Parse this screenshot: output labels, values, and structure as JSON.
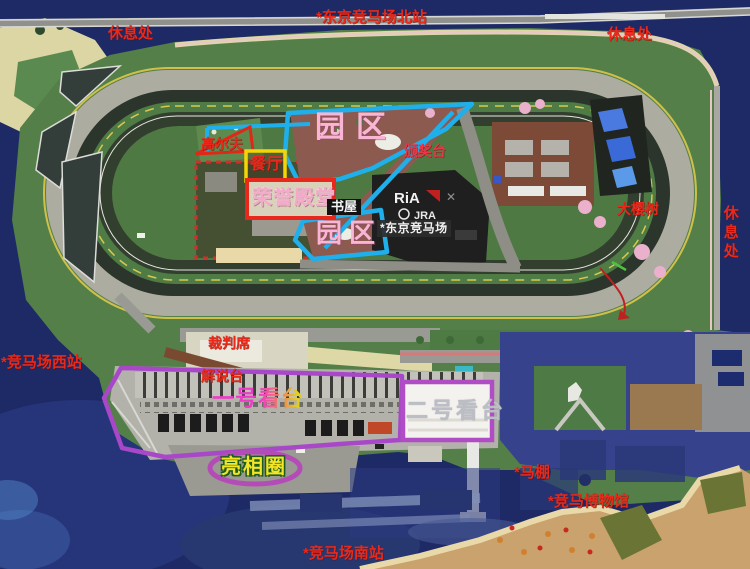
{
  "map": {
    "title": "东京竞马场",
    "colors": {
      "water": "#1d2a66",
      "grass": "#547f49",
      "annotation_red": "#e8291b",
      "annotation_cyan": "#1fb0ec",
      "annotation_purple": "#a848c8",
      "annotation_magenta": "#b44cb8",
      "box_yellow": "#f5d504",
      "box_red": "#e8281c",
      "park_pink": "#f8b6d4",
      "paddock_yellow": "#f2e428",
      "grandstand1_magenta": "#ee3cc8"
    },
    "labels": {
      "rest_area_top_left": "休息处",
      "north_station": "*东京竞马场北站",
      "rest_area_top_right": "休息处",
      "golf": "高尔夫",
      "park_zone_upper": "园区",
      "restaurant": "餐厅",
      "hall_of_fame": "荣誉殿堂",
      "book_house": "书屋",
      "award_stage": "颁奖台",
      "park_zone_lower": "园区",
      "racecourse_name": "*东京竞马场",
      "big_cherry_tree": "大樱树",
      "rest_area_right": "休息处",
      "west_station": "*竞马场西站",
      "judges_stand": "裁判席",
      "commentary_stand": "解说台",
      "grandstand_one": "一号看台",
      "grandstand_two": "二号看台",
      "paddock_ring": "亮相圈",
      "horse_stable": "*马棚",
      "racing_museum": "*竞马博物馆",
      "south_station": "*竞马场南站"
    },
    "logo": {
      "ria": "RiA",
      "times": "✕",
      "jra": "JRA"
    }
  }
}
